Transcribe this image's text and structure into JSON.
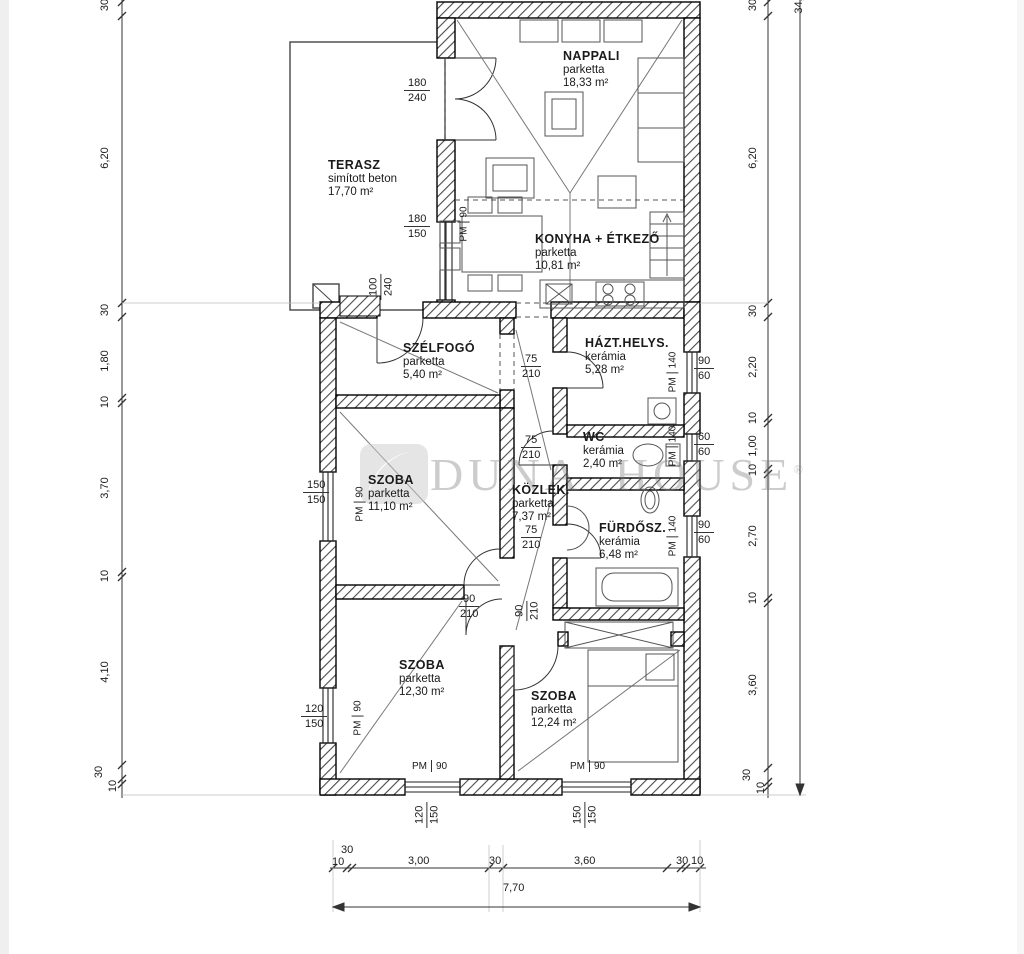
{
  "watermark": {
    "brand": "DUNA HOUSE",
    "reg": "®"
  },
  "rooms": {
    "nappali": {
      "name": "NAPPALI",
      "finish": "parketta",
      "area": "18,33 m²"
    },
    "terasz": {
      "name": "TERASZ",
      "finish": "simított beton",
      "area": "17,70 m²"
    },
    "konyha": {
      "name": "KONYHA + ÉTKEZŐ",
      "finish": "parketta",
      "area": "10,81 m²"
    },
    "szelfogo": {
      "name": "SZÉLFOGÓ",
      "finish": "parketta",
      "area": "5,40 m²"
    },
    "hazt": {
      "name": "HÁZT.HELYS.",
      "finish": "kerámia",
      "area": "5,28 m²"
    },
    "wc": {
      "name": "WC",
      "finish": "kerámia",
      "area": "2,40 m²"
    },
    "szoba1": {
      "name": "SZOBA",
      "finish": "parketta",
      "area": "11,10 m²"
    },
    "kozlek": {
      "name": "KÖZLEK.",
      "finish": "parketta",
      "area": "7,37 m²"
    },
    "furdo": {
      "name": "FÜRDŐSZ.",
      "finish": "kerámia",
      "area": "6,48 m²"
    },
    "szoba2": {
      "name": "SZOBA",
      "finish": "parketta",
      "area": "12,30 m²"
    },
    "szoba3": {
      "name": "SZOBA",
      "finish": "parketta",
      "area": "12,24 m²"
    }
  },
  "openings": {
    "terasz_ajto": {
      "w": "180",
      "h": "240"
    },
    "konyha_ablak": {
      "w": "180",
      "h": "150"
    },
    "bejarat": {
      "w": "100",
      "h": "240"
    },
    "ajto75": {
      "w": "75",
      "h": "210"
    },
    "ajto90": {
      "w": "90",
      "h": "210"
    },
    "ablak_szoba1": {
      "w": "150",
      "h": "150"
    },
    "ablak_szoba2": {
      "w": "120",
      "h": "150"
    },
    "ablak_hazt": {
      "w": "90",
      "h": "60"
    },
    "ablak_wc": {
      "w": "60",
      "h": "60"
    },
    "ablak_furdo": {
      "w": "90",
      "h": "60"
    },
    "ablak_del1": {
      "w": "120",
      "h": "150"
    },
    "ablak_del2": {
      "w": "150",
      "h": "150"
    },
    "pm": "PM",
    "pm90": "90",
    "pm140": "140"
  },
  "dims": {
    "left": [
      "30",
      "6,20",
      "30",
      "1,80",
      "10",
      "3,70",
      "10",
      "4,10",
      "30",
      "10"
    ],
    "right": [
      "30",
      "6,20",
      "30",
      "2,20",
      "10",
      "1,00",
      "10",
      "2,70",
      "10",
      "3,60",
      "30",
      "10"
    ],
    "right_total": "34,",
    "bottom": [
      "30",
      "10",
      "3,00",
      "30",
      "3,60",
      "30",
      "10"
    ],
    "bottom_total": "7,70"
  }
}
